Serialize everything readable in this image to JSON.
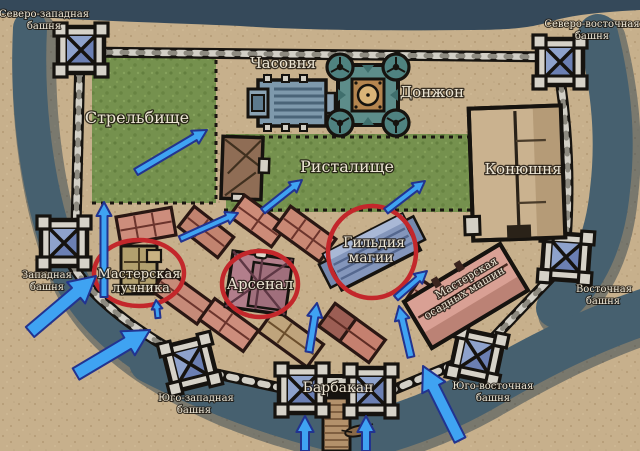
{
  "map": {
    "description": "Top-down fantasy castle map with Russian labels, blue attack arrows and red highlight circles",
    "language": "ru",
    "colors": {
      "sand": "#c7b08c",
      "sand_dot": "#b79d78",
      "water": "#46606f",
      "water_dark": "#35495a",
      "water_shadow": "#2e4150",
      "grass": "#75914e",
      "grass_dark": "#637f3f",
      "wall_black": "#16130f",
      "wall_block_light": "#d2cfc6",
      "wall_block_dark": "#8d8a80",
      "tower_blue": "#6b7fb3",
      "tower_blue_light": "#8ea2cc",
      "donjon_teal": "#5d8d8a",
      "chapel_blue": "#7e99ac",
      "stable_tan": "#cab28f",
      "house_salmon": "#cd8d7c",
      "arsenal_mauve": "#b27e8b",
      "guild_blue": "#8496bb",
      "siege_pink": "#d9a094",
      "arrow_fill": "#3fa3f2",
      "arrow_outline": "#22338f",
      "circle_red": "#c3272b",
      "label_fill": "#ece5d4"
    },
    "labels": [
      {
        "id": "nw-tower-1",
        "text": "Северо-западная",
        "x": 44,
        "y": 17,
        "size": 10,
        "rot": 0
      },
      {
        "id": "nw-tower-2",
        "text": "башня",
        "x": 44,
        "y": 29,
        "size": 10,
        "rot": 0
      },
      {
        "id": "ne-tower-1",
        "text": "Северо-восточная",
        "x": 592,
        "y": 27,
        "size": 10,
        "rot": 0
      },
      {
        "id": "ne-tower-2",
        "text": "башня",
        "x": 592,
        "y": 39,
        "size": 10,
        "rot": 0
      },
      {
        "id": "chapel",
        "text": "Часовня",
        "x": 283,
        "y": 68,
        "size": 15,
        "rot": 0
      },
      {
        "id": "donjon",
        "text": "Донжон",
        "x": 432,
        "y": 97,
        "size": 15,
        "rot": 0
      },
      {
        "id": "shooting-range",
        "text": "Стрельбище",
        "x": 137,
        "y": 123,
        "size": 16,
        "rot": 0
      },
      {
        "id": "lists-field",
        "text": "Ристалище",
        "x": 347,
        "y": 172,
        "size": 16,
        "rot": 0
      },
      {
        "id": "stable",
        "text": "Конюшня",
        "x": 523,
        "y": 174,
        "size": 15,
        "rot": 0
      },
      {
        "id": "w-tower-1",
        "text": "Западная",
        "x": 47,
        "y": 278,
        "size": 10,
        "rot": 0
      },
      {
        "id": "w-tower-2",
        "text": "башня",
        "x": 47,
        "y": 290,
        "size": 10,
        "rot": 0
      },
      {
        "id": "e-tower-1",
        "text": "Восточная",
        "x": 604,
        "y": 292,
        "size": 10,
        "rot": 0
      },
      {
        "id": "e-tower-2",
        "text": "башня",
        "x": 603,
        "y": 304,
        "size": 10,
        "rot": 0
      },
      {
        "id": "sw-tower-1",
        "text": "Юго-западная",
        "x": 196,
        "y": 401,
        "size": 10,
        "rot": 0
      },
      {
        "id": "sw-tower-2",
        "text": "башня",
        "x": 194,
        "y": 413,
        "size": 10,
        "rot": 0
      },
      {
        "id": "se-tower-1",
        "text": "Юго-восточная",
        "x": 493,
        "y": 389,
        "size": 10,
        "rot": 0
      },
      {
        "id": "se-tower-2",
        "text": "башня",
        "x": 493,
        "y": 401,
        "size": 10,
        "rot": 0
      },
      {
        "id": "barbican",
        "text": "Барбакан",
        "x": 338,
        "y": 392,
        "size": 14,
        "rot": 0
      },
      {
        "id": "archer-shop-1",
        "text": "Мастерская",
        "x": 139,
        "y": 278,
        "size": 13,
        "rot": 0
      },
      {
        "id": "archer-shop-2",
        "text": "лучника",
        "x": 141,
        "y": 292,
        "size": 13,
        "rot": 0
      },
      {
        "id": "arsenal",
        "text": "Арсенал",
        "x": 260,
        "y": 289,
        "size": 15,
        "rot": 0
      },
      {
        "id": "magic-guild-1",
        "text": "Гильдия",
        "x": 374,
        "y": 247,
        "size": 14,
        "rot": 0
      },
      {
        "id": "magic-guild-2",
        "text": "магии",
        "x": 371,
        "y": 262,
        "size": 14,
        "rot": 0
      },
      {
        "id": "siege-shop-1",
        "text": "Мастерская",
        "x": 468,
        "y": 281,
        "size": 11,
        "rot": -31
      },
      {
        "id": "siege-shop-2",
        "text": "осадных машин",
        "x": 466,
        "y": 296,
        "size": 11,
        "rot": -31
      }
    ],
    "highlight_circles": [
      {
        "id": "archer-shop",
        "cx": 139,
        "cy": 273,
        "rx": 45,
        "ry": 33
      },
      {
        "id": "arsenal",
        "cx": 260,
        "cy": 284,
        "rx": 38,
        "ry": 33
      },
      {
        "id": "magic-guild",
        "cx": 372,
        "cy": 252,
        "rx": 44,
        "ry": 46
      }
    ],
    "arrows": [
      {
        "id": "a1",
        "x1": 30,
        "y1": 332,
        "x2": 96,
        "y2": 276,
        "w": 13
      },
      {
        "id": "a2",
        "x1": 76,
        "y1": 374,
        "x2": 150,
        "y2": 330,
        "w": 13
      },
      {
        "id": "a3",
        "x1": 158,
        "y1": 318,
        "x2": 156,
        "y2": 300,
        "w": 5
      },
      {
        "id": "a4",
        "x1": 104,
        "y1": 297,
        "x2": 104,
        "y2": 202,
        "w": 7
      },
      {
        "id": "a5",
        "x1": 136,
        "y1": 172,
        "x2": 207,
        "y2": 130,
        "w": 7
      },
      {
        "id": "a6",
        "x1": 180,
        "y1": 239,
        "x2": 238,
        "y2": 213,
        "w": 6
      },
      {
        "id": "a7",
        "x1": 263,
        "y1": 211,
        "x2": 302,
        "y2": 180,
        "w": 6
      },
      {
        "id": "a8",
        "x1": 386,
        "y1": 211,
        "x2": 425,
        "y2": 181,
        "w": 6
      },
      {
        "id": "a9",
        "x1": 396,
        "y1": 298,
        "x2": 427,
        "y2": 271,
        "w": 6
      },
      {
        "id": "a10",
        "x1": 309,
        "y1": 352,
        "x2": 317,
        "y2": 303,
        "w": 7
      },
      {
        "id": "a11",
        "x1": 411,
        "y1": 357,
        "x2": 399,
        "y2": 306,
        "w": 7
      },
      {
        "id": "a12",
        "x1": 305,
        "y1": 451,
        "x2": 305,
        "y2": 416,
        "w": 8
      },
      {
        "id": "a13",
        "x1": 366,
        "y1": 451,
        "x2": 366,
        "y2": 416,
        "w": 8
      },
      {
        "id": "a14",
        "x1": 460,
        "y1": 440,
        "x2": 423,
        "y2": 366,
        "w": 12
      }
    ]
  }
}
